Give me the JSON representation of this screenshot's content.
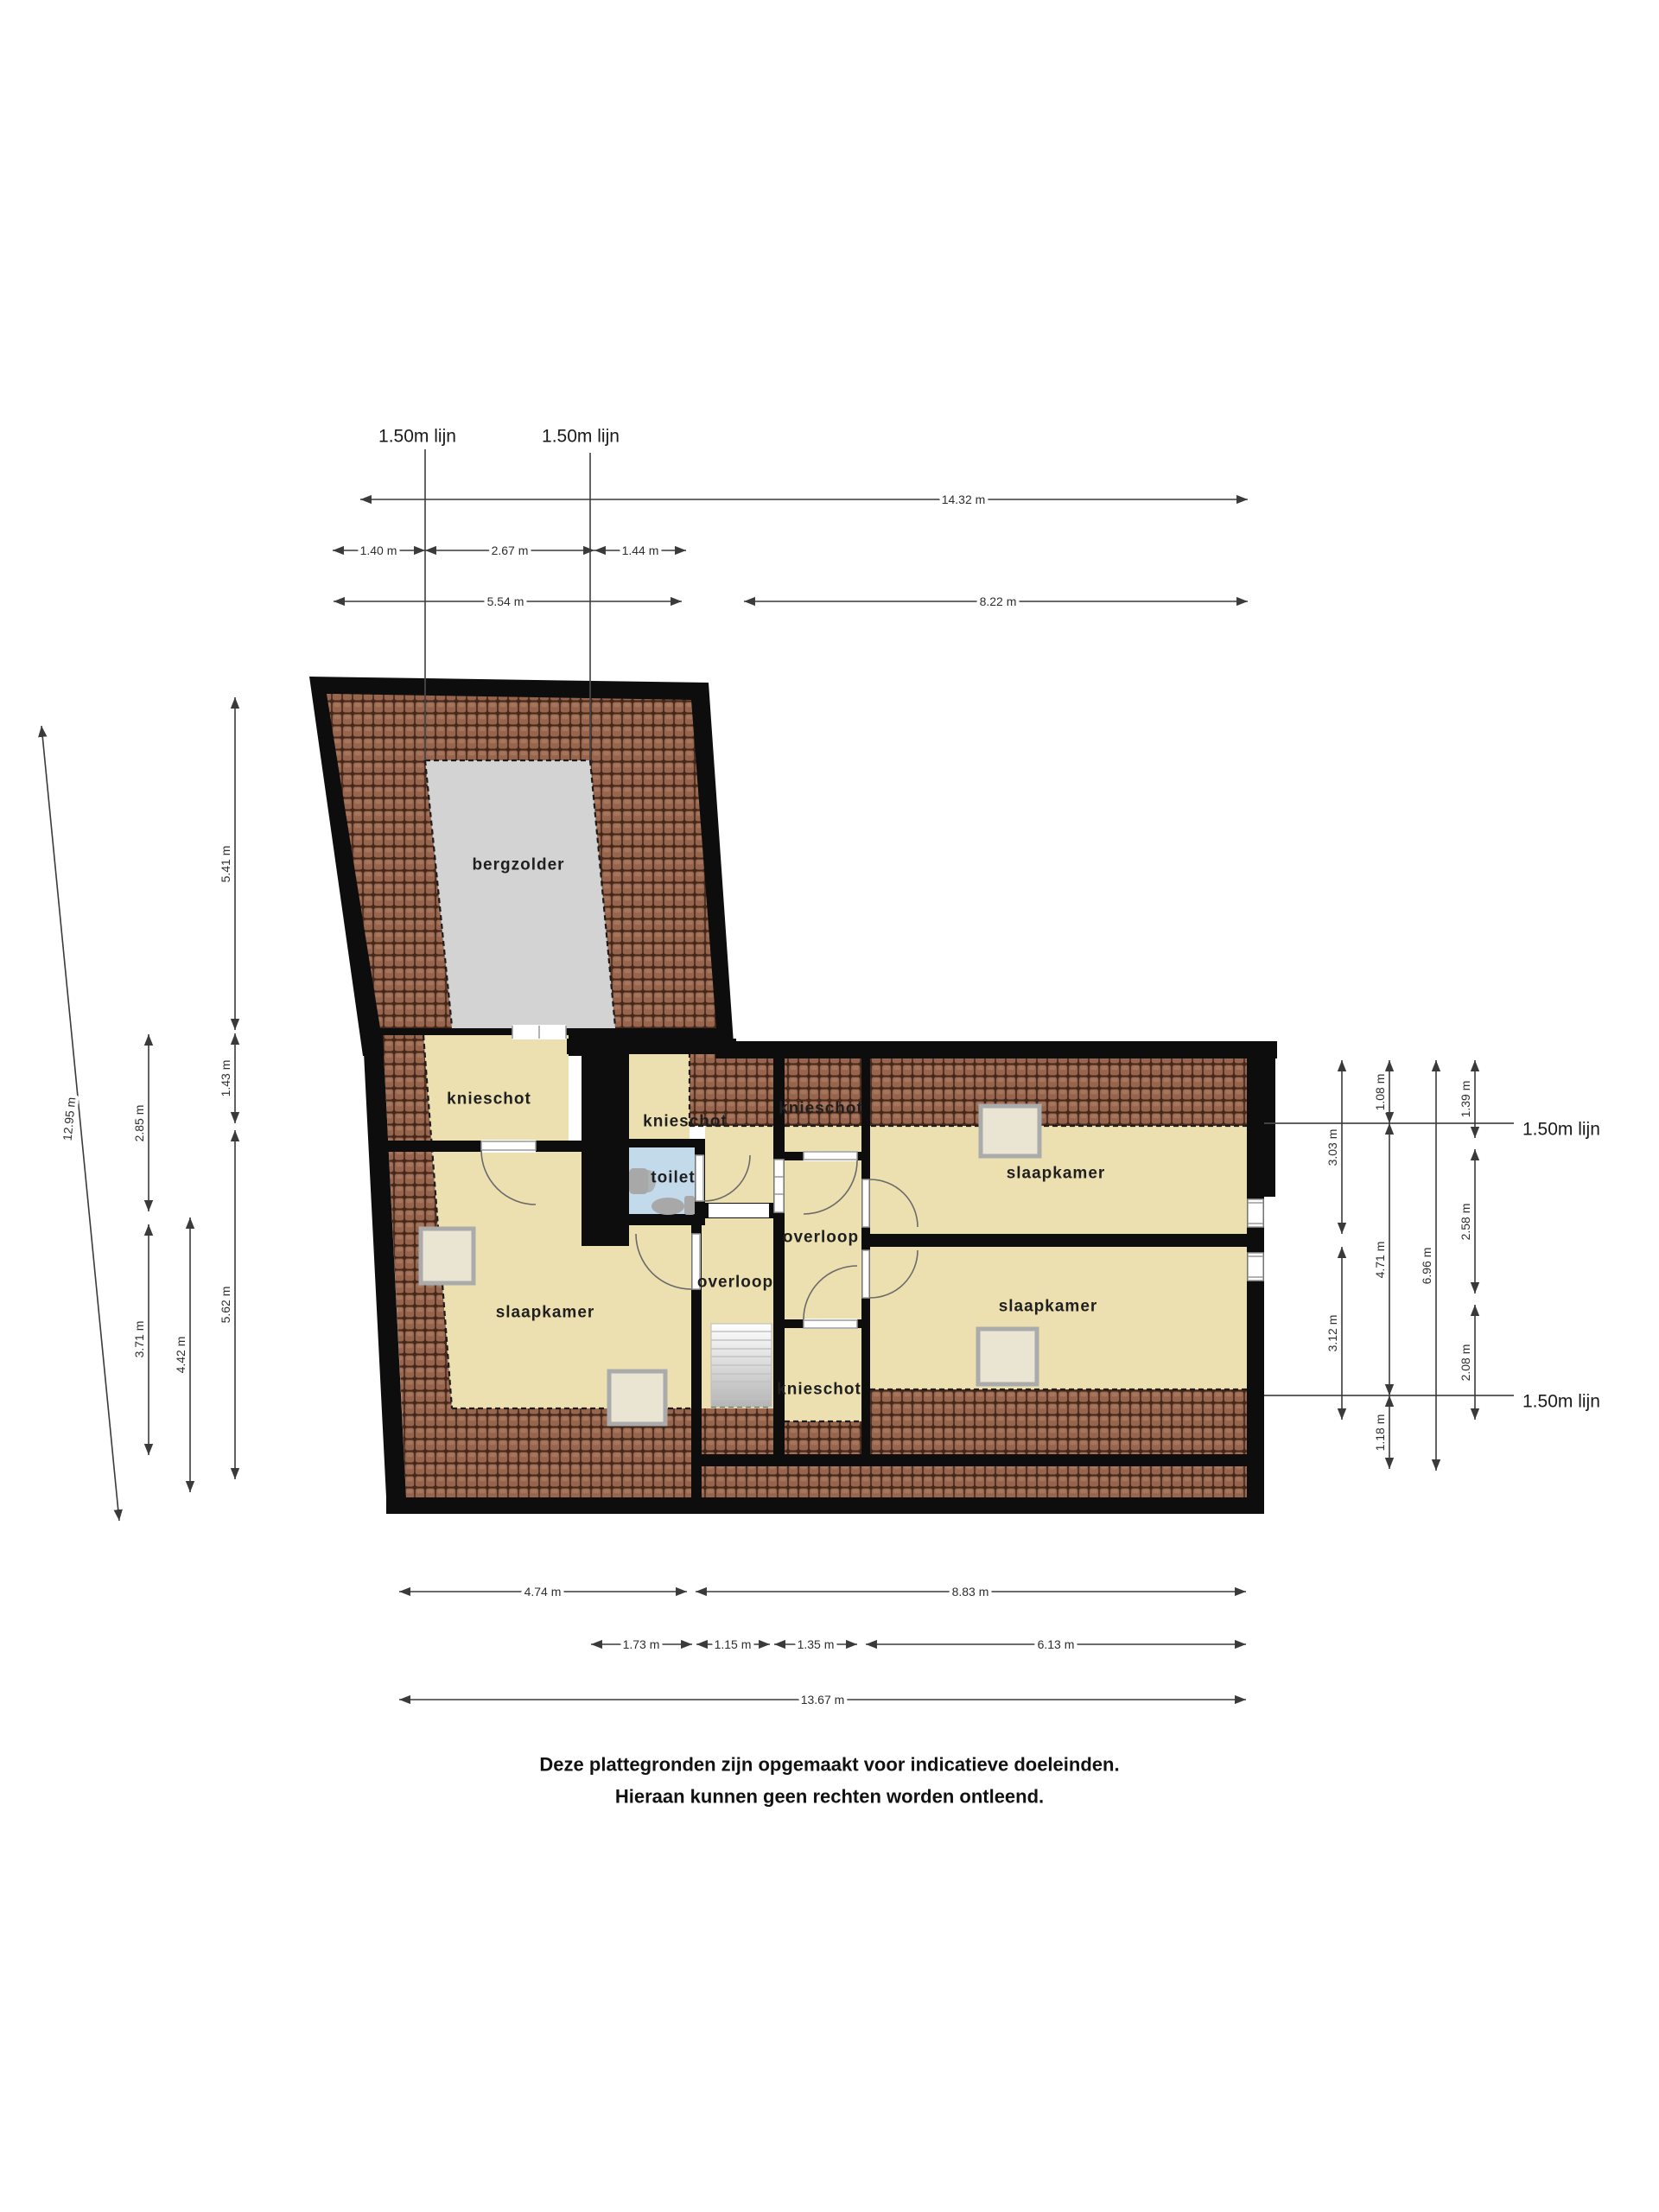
{
  "rooms": {
    "attic": "bergzolder",
    "knee_wall": "knieschot",
    "toilet": "toilet",
    "landing": "overloop",
    "bedroom": "slaapkamer"
  },
  "height_line_label": "1.50m lijn",
  "dims": {
    "top": [
      "14.32 m",
      "1.40 m",
      "2.67 m",
      "1.44 m",
      "5.54 m",
      "8.22 m"
    ],
    "left": [
      "12.95 m",
      "5.41 m",
      "1.43 m",
      "2.85 m",
      "5.62 m",
      "3.71 m",
      "4.42 m"
    ],
    "right": [
      "3.03 m",
      "3.12 m",
      "1.08 m",
      "4.71 m",
      "1.18 m",
      "6.96 m",
      "1.39 m",
      "2.58 m",
      "2.08 m"
    ],
    "bottom": [
      "4.74 m",
      "8.83 m",
      "1.73 m",
      "1.15 m",
      "1.35 m",
      "6.13 m",
      "13.67 m"
    ]
  },
  "footer": {
    "line1": "Deze plattegronden zijn opgemaakt voor indicatieve doeleinden.",
    "line2": "Hieraan kunnen geen rechten worden ontleend."
  },
  "colors": {
    "wall": "#0d0d0d",
    "roof_tile": "#97654d",
    "roof_dark": "#46281b",
    "roof_hi": "#a5755c",
    "room": "#ece0b0",
    "attic": "#d3d3d3",
    "toilet": "#c2daea",
    "dim": "#3a3a3a"
  }
}
